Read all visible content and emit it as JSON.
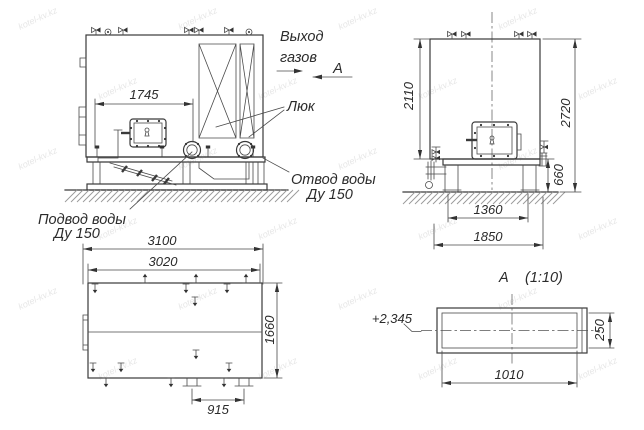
{
  "watermark": {
    "text": "kotel-kv.kz"
  },
  "colors": {
    "line": "#3a3a3a",
    "thin_line": "#4a4a4a",
    "ground_hatch": "#9a9a9a",
    "background": "#ffffff",
    "watermark": "#d3d3d3"
  },
  "annotations": {
    "gas_outlet_line1": "Выход",
    "gas_outlet_line2": "газов",
    "view_marker": "A",
    "hatch_label": "Люк",
    "water_outlet_line1": "Отвод воды",
    "water_outlet_line2": "Ду 150",
    "water_inlet_line1": "Подвод воды",
    "water_inlet_line2": "Ду 150"
  },
  "front_view": {
    "dim_hatch_offset": "1745"
  },
  "side_view": {
    "dim_body_height": "2110",
    "dim_total_height": "2720",
    "dim_base_height": "660",
    "dim_leg_span": "1360",
    "dim_base_width": "1850"
  },
  "plan_view": {
    "dim_length_overall": "3100",
    "dim_length_body": "3020",
    "dim_width": "1660",
    "dim_support_span": "915"
  },
  "section_a": {
    "marker": "A",
    "scale": "(1:10)",
    "elevation": "+2,345",
    "dim_width": "1010",
    "dim_height": "250"
  }
}
